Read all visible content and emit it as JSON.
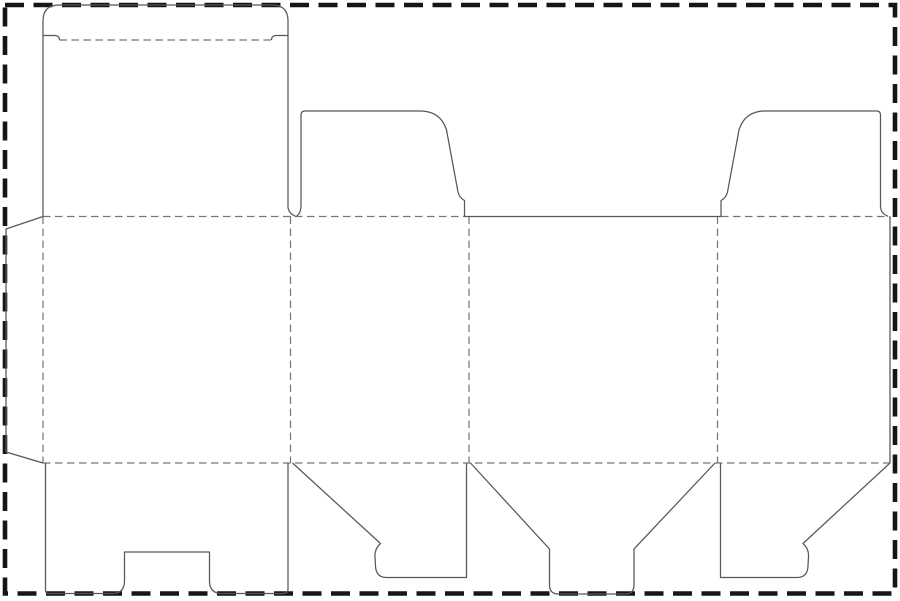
{
  "canvas": {
    "width": 900,
    "height": 601,
    "background": "#ffffff"
  },
  "dieline": {
    "name": "box-dieline-template",
    "border": {
      "x": 5,
      "y": 5,
      "width": 890,
      "height": 588.5,
      "color": "#161616",
      "thickness": 4.6,
      "dash": "19 9.5"
    },
    "cut_style": {
      "color": "#575757",
      "width": 1.25
    },
    "fold_style": {
      "color": "#767676",
      "width": 1.2,
      "dash": "7.5 4.5"
    },
    "cut_paths": [
      {
        "name": "tuck-lid-outline",
        "d": "M 43 216.2 L 43 21 Q 43 5 59 5 L 272 5 Q 288 5 288 21 L 288 207 Q 288.5 213.5 295.5 216.2"
      },
      {
        "name": "tuck-shoulder-left",
        "d": "M 43 35.5 L 55.5 35.5 Q 59.5 36 59.5 40"
      },
      {
        "name": "tuck-shoulder-right",
        "d": "M 288 35.5 L 275.5 35.5 Q 271.5 36 271.5 40"
      },
      {
        "name": "glue-flap-outline",
        "d": "M 43 216.5 L 6 229 L 6 452 L 43 463"
      },
      {
        "name": "dust-flap-left-outline",
        "d": "M 296.5 216.3 Q 300.5 213.5 301 207 L 301 115 Q 301 111 305 111 L 422 111 Q 441 112 446.5 130 L 458 192 Q 459.5 198 464.5 200.5 L 464.5 216.5"
      },
      {
        "name": "back-panel-top-edge",
        "d": "M 464.5 216.5 L 721 216.5"
      },
      {
        "name": "dust-flap-right-outline",
        "d": "M 721 216.5 L 721 200.5 Q 726 198 727.5 192 L 739 130 Q 744.5 112 763.5 111 L 876.5 111 Q 880.5 111 880.5 115 L 880.5 207 Q 881 213.5 888 216.3"
      },
      {
        "name": "right-panel-edge",
        "d": "M 890 216.5 L 890 463"
      },
      {
        "name": "bottom-lock-flap-outline",
        "d": "M 45.5 463 L 45.5 590 Q 45.5 593.5 49 593.5 L 112 593.5 Q 124.5 593.5 124.5 581 L 124.5 552 L 209.5 552 L 209.5 581 Q 209.5 593.5 222 593.5 L 283.5 593.5 Q 288 593.5 288 589 L 288 463"
      },
      {
        "name": "bottom-side-flap-left-outline",
        "d": "M 292.5 463 L 380.5 543.5 Q 374.5 548.5 375 557 L 375.5 566 Q 376 577.5 386.5 577.5 L 466.5 577.5 L 466.5 463"
      },
      {
        "name": "bottom-tongue-flap-outline",
        "d": "M 470.5 463 L 549.5 549 L 549.5 585 Q 549.5 594 558.5 594 L 625 594 Q 634 594 634 585 L 634 549 L 715 463"
      },
      {
        "name": "bottom-side-flap-right-outline",
        "d": "M 890 463 L 803 543.5 Q 809 548.5 808.5 557 L 808 566 Q 807.5 577.5 797 577.5 L 720.5 577.5 L 720.5 463"
      }
    ],
    "fold_lines": [
      {
        "name": "tuck-fold",
        "x1": 59.5,
        "y1": 40,
        "x2": 271.5,
        "y2": 40
      },
      {
        "name": "top-fold-left",
        "x1": 43,
        "y1": 216.5,
        "x2": 464.5,
        "y2": 216.5
      },
      {
        "name": "top-fold-right",
        "x1": 721,
        "y1": 216.5,
        "x2": 890,
        "y2": 216.5
      },
      {
        "name": "bottom-fold",
        "x1": 43,
        "y1": 463,
        "x2": 890,
        "y2": 463
      },
      {
        "name": "glue-panel-fold",
        "x1": 43,
        "y1": 216.5,
        "x2": 43,
        "y2": 463
      },
      {
        "name": "panel-fold-1",
        "x1": 290.5,
        "y1": 216.5,
        "x2": 290.5,
        "y2": 463
      },
      {
        "name": "panel-fold-2",
        "x1": 469,
        "y1": 216.5,
        "x2": 469,
        "y2": 463
      },
      {
        "name": "panel-fold-3",
        "x1": 717.5,
        "y1": 216.5,
        "x2": 717.5,
        "y2": 463
      }
    ]
  }
}
